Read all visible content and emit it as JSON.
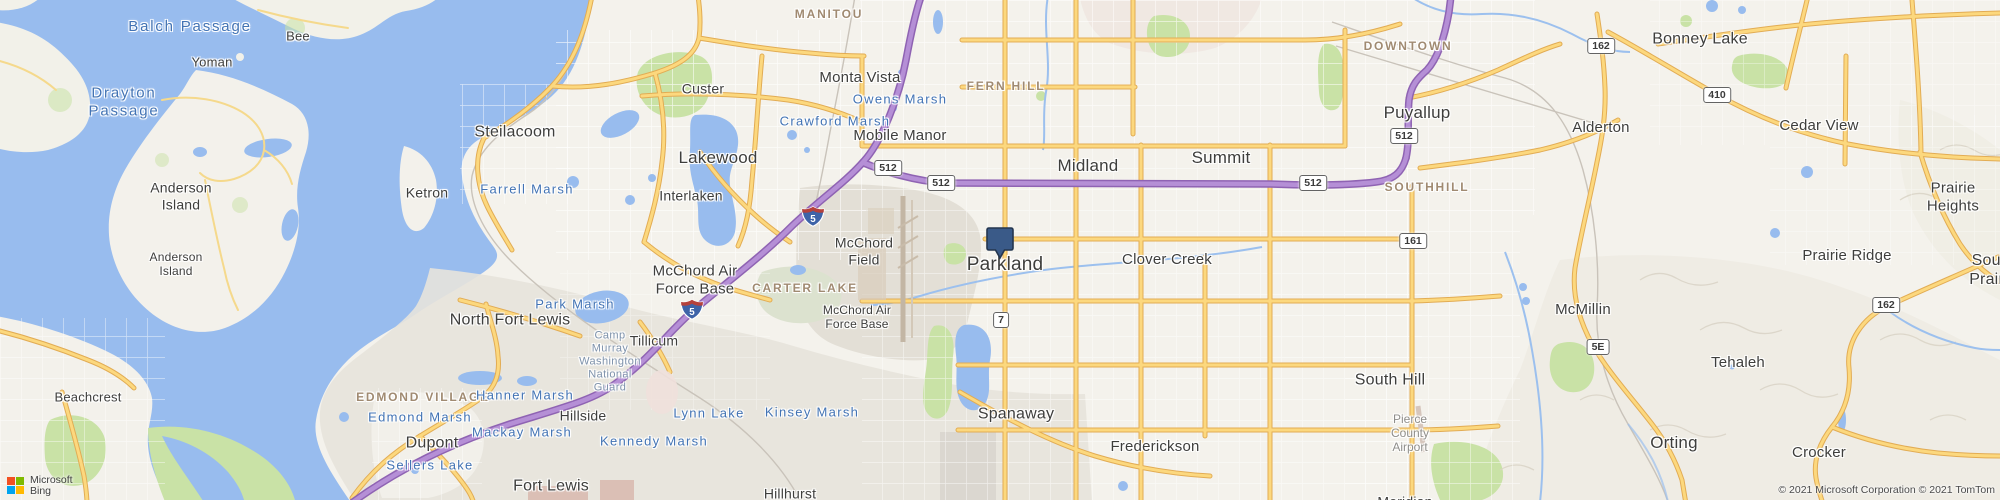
{
  "map": {
    "marker": {
      "x": 1000,
      "y": 258,
      "color": "#3a5a88",
      "border": "#24364f"
    },
    "labels": [
      {
        "id": "balch-passage",
        "text": "Balch Passage",
        "x": 190,
        "y": 27,
        "kind": "waterbig",
        "size": 15
      },
      {
        "id": "bee",
        "text": "Bee",
        "x": 298,
        "y": 36,
        "kind": "city",
        "size": 13
      },
      {
        "id": "yoman",
        "text": "Yoman",
        "x": 212,
        "y": 62,
        "kind": "city",
        "size": 13
      },
      {
        "id": "drayton-passage",
        "text": "Drayton\nPassage",
        "x": 124,
        "y": 102,
        "kind": "waterbig",
        "size": 15
      },
      {
        "id": "anderson-island-1",
        "text": "Anderson\nIsland",
        "x": 181,
        "y": 196,
        "kind": "city",
        "size": 14
      },
      {
        "id": "anderson-island-2",
        "text": "Anderson\nIsland",
        "x": 176,
        "y": 264,
        "kind": "city",
        "size": 12
      },
      {
        "id": "ketron",
        "text": "Ketron",
        "x": 427,
        "y": 193,
        "kind": "city",
        "size": 14
      },
      {
        "id": "beachcrest",
        "text": "Beachcrest",
        "x": 88,
        "y": 397,
        "kind": "city",
        "size": 13
      },
      {
        "id": "steilacoom",
        "text": "Steilacoom",
        "x": 515,
        "y": 133,
        "kind": "city",
        "size": 16
      },
      {
        "id": "farrell-marsh",
        "text": "Farrell Marsh",
        "x": 527,
        "y": 189,
        "kind": "water",
        "size": 13
      },
      {
        "id": "custer",
        "text": "Custer",
        "x": 703,
        "y": 89,
        "kind": "city",
        "size": 14
      },
      {
        "id": "lakewood",
        "text": "Lakewood",
        "x": 718,
        "y": 158,
        "kind": "city",
        "size": 17
      },
      {
        "id": "interlaken",
        "text": "Interlaken",
        "x": 691,
        "y": 196,
        "kind": "city",
        "size": 14
      },
      {
        "id": "crawford-marsh",
        "text": "Crawford Marsh",
        "x": 835,
        "y": 121,
        "kind": "water",
        "size": 13
      },
      {
        "id": "owens-marsh",
        "text": "Owens Marsh",
        "x": 900,
        "y": 99,
        "kind": "water",
        "size": 13
      },
      {
        "id": "monta-vista",
        "text": "Monta Vista",
        "x": 860,
        "y": 78,
        "kind": "city",
        "size": 15
      },
      {
        "id": "manitou",
        "text": "MANITOU",
        "x": 829,
        "y": 14,
        "kind": "area",
        "size": 12
      },
      {
        "id": "mobile-manor",
        "text": "Mobile Manor",
        "x": 900,
        "y": 136,
        "kind": "city",
        "size": 15
      },
      {
        "id": "fern-hill",
        "text": "FERN HILL",
        "x": 1006,
        "y": 86,
        "kind": "area",
        "size": 12
      },
      {
        "id": "midland",
        "text": "Midland",
        "x": 1088,
        "y": 166,
        "kind": "city",
        "size": 17
      },
      {
        "id": "summit",
        "text": "Summit",
        "x": 1221,
        "y": 158,
        "kind": "city",
        "size": 17
      },
      {
        "id": "puyallup",
        "text": "Puyallup",
        "x": 1417,
        "y": 113,
        "kind": "city",
        "size": 17
      },
      {
        "id": "downtown",
        "text": "DOWNTOWN",
        "x": 1408,
        "y": 46,
        "kind": "area",
        "size": 12
      },
      {
        "id": "southhill",
        "text": "SOUTHHILL",
        "x": 1427,
        "y": 187,
        "kind": "area",
        "size": 12
      },
      {
        "id": "clover-creek",
        "text": "Clover Creek",
        "x": 1167,
        "y": 260,
        "kind": "city",
        "size": 15
      },
      {
        "id": "bonney-lake",
        "text": "Bonney Lake",
        "x": 1700,
        "y": 40,
        "kind": "city",
        "size": 16
      },
      {
        "id": "alderton",
        "text": "Alderton",
        "x": 1601,
        "y": 128,
        "kind": "city",
        "size": 15
      },
      {
        "id": "cedar-view",
        "text": "Cedar View",
        "x": 1819,
        "y": 126,
        "kind": "city",
        "size": 15
      },
      {
        "id": "prairie-heights",
        "text": "Prairie\nHeights",
        "x": 1953,
        "y": 197,
        "kind": "city",
        "size": 15
      },
      {
        "id": "prairie-ridge",
        "text": "Prairie Ridge",
        "x": 1847,
        "y": 256,
        "kind": "city",
        "size": 15
      },
      {
        "id": "south-prairie",
        "text": "South Prairie",
        "x": 1993,
        "y": 271,
        "kind": "city",
        "size": 16
      },
      {
        "id": "south-hill",
        "text": "South Hill",
        "x": 1390,
        "y": 381,
        "kind": "city",
        "size": 16
      },
      {
        "id": "mcmillin",
        "text": "McMillin",
        "x": 1583,
        "y": 310,
        "kind": "city",
        "size": 15
      },
      {
        "id": "tehaleh",
        "text": "Tehaleh",
        "x": 1738,
        "y": 363,
        "kind": "city",
        "size": 15
      },
      {
        "id": "orting",
        "text": "Orting",
        "x": 1674,
        "y": 443,
        "kind": "city",
        "size": 17
      },
      {
        "id": "crocker",
        "text": "Crocker",
        "x": 1819,
        "y": 453,
        "kind": "city",
        "size": 15
      },
      {
        "id": "pierce-county-airport",
        "text": "Pierce\nCounty\nAirport",
        "x": 1410,
        "y": 433,
        "kind": "gray",
        "size": 12
      },
      {
        "id": "spanaway",
        "text": "Spanaway",
        "x": 1016,
        "y": 415,
        "kind": "city",
        "size": 16
      },
      {
        "id": "frederickson",
        "text": "Frederickson",
        "x": 1155,
        "y": 447,
        "kind": "city",
        "size": 15
      },
      {
        "id": "hillhurst",
        "text": "Hillhurst",
        "x": 790,
        "y": 494,
        "kind": "city",
        "size": 14
      },
      {
        "id": "meridian",
        "text": "Meridian",
        "x": 1405,
        "y": 502,
        "kind": "city",
        "size": 14
      },
      {
        "id": "mcchord-field",
        "text": "McChord\nField",
        "x": 864,
        "y": 251,
        "kind": "city",
        "size": 14
      },
      {
        "id": "carter-lake",
        "text": "CARTER LAKE",
        "x": 805,
        "y": 288,
        "kind": "area",
        "size": 12
      },
      {
        "id": "mcchord-afb-east",
        "text": "McChord Air\nForce Base",
        "x": 857,
        "y": 317,
        "kind": "city",
        "size": 12
      },
      {
        "id": "mcchord-afb-west",
        "text": "McChord Air\nForce Base",
        "x": 695,
        "y": 280,
        "kind": "city",
        "size": 15
      },
      {
        "id": "north-fort-lewis",
        "text": "North Fort Lewis",
        "x": 510,
        "y": 321,
        "kind": "city",
        "size": 16
      },
      {
        "id": "park-marsh",
        "text": "Park Marsh",
        "x": 575,
        "y": 304,
        "kind": "water",
        "size": 13
      },
      {
        "id": "camp-murray",
        "text": "Camp\nMurray\nWashington\nNational\nGuard",
        "x": 610,
        "y": 362,
        "kind": "mil",
        "size": 11
      },
      {
        "id": "tillicum",
        "text": "Tillicum",
        "x": 654,
        "y": 341,
        "kind": "city",
        "size": 14
      },
      {
        "id": "edmond-village",
        "text": "EDMOND VILLAGE",
        "x": 423,
        "y": 397,
        "kind": "area",
        "size": 12
      },
      {
        "id": "edmond-marsh",
        "text": "Edmond Marsh",
        "x": 420,
        "y": 417,
        "kind": "water",
        "size": 13
      },
      {
        "id": "hanner-marsh",
        "text": "Hanner Marsh",
        "x": 525,
        "y": 395,
        "kind": "water",
        "size": 13
      },
      {
        "id": "hillside",
        "text": "Hillside",
        "x": 583,
        "y": 416,
        "kind": "city",
        "size": 14
      },
      {
        "id": "lynn-lake",
        "text": "Lynn Lake",
        "x": 709,
        "y": 413,
        "kind": "water",
        "size": 13
      },
      {
        "id": "mackay-marsh",
        "text": "Mackay Marsh",
        "x": 522,
        "y": 432,
        "kind": "water",
        "size": 13
      },
      {
        "id": "kennedy-marsh",
        "text": "Kennedy Marsh",
        "x": 654,
        "y": 441,
        "kind": "water",
        "size": 13
      },
      {
        "id": "dupont",
        "text": "Dupont",
        "x": 432,
        "y": 444,
        "kind": "city",
        "size": 16
      },
      {
        "id": "sellers-lake",
        "text": "Sellers Lake",
        "x": 430,
        "y": 465,
        "kind": "water",
        "size": 13
      },
      {
        "id": "fort-lewis",
        "text": "Fort Lewis",
        "x": 551,
        "y": 487,
        "kind": "city",
        "size": 16
      },
      {
        "id": "kinsey-marsh",
        "text": "Kinsey Marsh",
        "x": 812,
        "y": 412,
        "kind": "water",
        "size": 13
      },
      {
        "id": "parkland",
        "text": "Parkland",
        "x": 1005,
        "y": 265,
        "kind": "city",
        "size": 19
      }
    ],
    "shields": [
      {
        "type": "interstate",
        "label": "5",
        "x": 813,
        "y": 219
      },
      {
        "type": "interstate",
        "label": "5",
        "x": 692,
        "y": 312
      },
      {
        "type": "state",
        "label": "512",
        "x": 888,
        "y": 168
      },
      {
        "type": "state",
        "label": "512",
        "x": 941,
        "y": 183
      },
      {
        "type": "state",
        "label": "512",
        "x": 1313,
        "y": 183
      },
      {
        "type": "state",
        "label": "512",
        "x": 1404,
        "y": 136
      },
      {
        "type": "state",
        "label": "7",
        "x": 1001,
        "y": 320
      },
      {
        "type": "state",
        "label": "161",
        "x": 1413,
        "y": 241
      },
      {
        "type": "state",
        "label": "162",
        "x": 1601,
        "y": 46
      },
      {
        "type": "state",
        "label": "162",
        "x": 1886,
        "y": 305
      },
      {
        "type": "state",
        "label": "410",
        "x": 1717,
        "y": 95
      },
      {
        "type": "state",
        "label": "5E",
        "x": 1598,
        "y": 347
      }
    ],
    "colors": {
      "water": "#98BCEE",
      "land": "#F4F2EC",
      "military": "#E6E2D9",
      "urban_pink": "#EFE6E0",
      "green": "#C9E2A6",
      "road_yellow": "#FCD87E",
      "road_yellow_casing": "#E2AC54",
      "highway_purple": "#B58FD6",
      "highway_purple_casing": "#8F63B3",
      "interstate_blue": "#3E63A8",
      "interstate_red": "#B5413C"
    }
  },
  "attribution": {
    "logo_line1": "Microsoft",
    "logo_line2": "Bing",
    "logo_colors": [
      "#F25022",
      "#7FBA00",
      "#00A4EF",
      "#FFB900"
    ],
    "copyright": "© 2021 Microsoft Corporation © 2021 TomTom"
  }
}
